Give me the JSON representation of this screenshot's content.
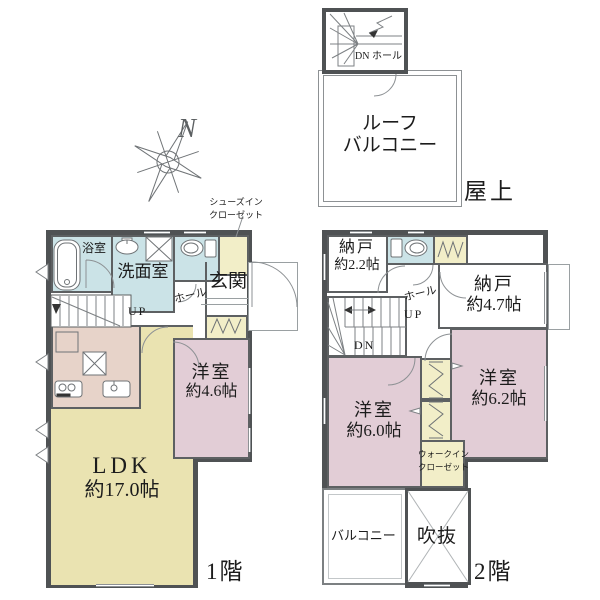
{
  "colors": {
    "wall": "#4f5254",
    "line": "#8d9194",
    "blue": "#cbe3e7",
    "yellow": "#eae3b1",
    "cream": "#f2eec8",
    "pink": "#e2cdd6",
    "kitchen": "#e7d3c9",
    "text": "#1c1c1c"
  },
  "compass": {
    "north": "N"
  },
  "roof": {
    "dn_hall": "DN ホール",
    "balcony_line1": "ルーフ",
    "balcony_line2": "バルコニー",
    "section": "屋上"
  },
  "f1": {
    "bath": "浴室",
    "washroom": "洗面室",
    "genkan": "玄関",
    "hall": "ホール",
    "up": "UP",
    "sic_line1": "シューズイン",
    "sic_line2": "クローゼット",
    "west_room": "洋室",
    "west_room_size": "約4.6帖",
    "ldk": "LDK",
    "ldk_size": "約17.0帖",
    "section": "1階"
  },
  "f2": {
    "storage_a": "納戸",
    "storage_a_size": "約2.2帖",
    "storage_b": "納戸",
    "storage_b_size": "約4.7帖",
    "hall": "ホール",
    "up": "UP",
    "dn": "DN",
    "room_e": "洋室",
    "room_e_size": "約6.2帖",
    "room_w": "洋室",
    "room_w_size": "約6.0帖",
    "wic_line1": "ウォークイン",
    "wic_line2": "クローゼット",
    "balcony": "バルコニー",
    "void": "吹抜",
    "section": "2階"
  }
}
